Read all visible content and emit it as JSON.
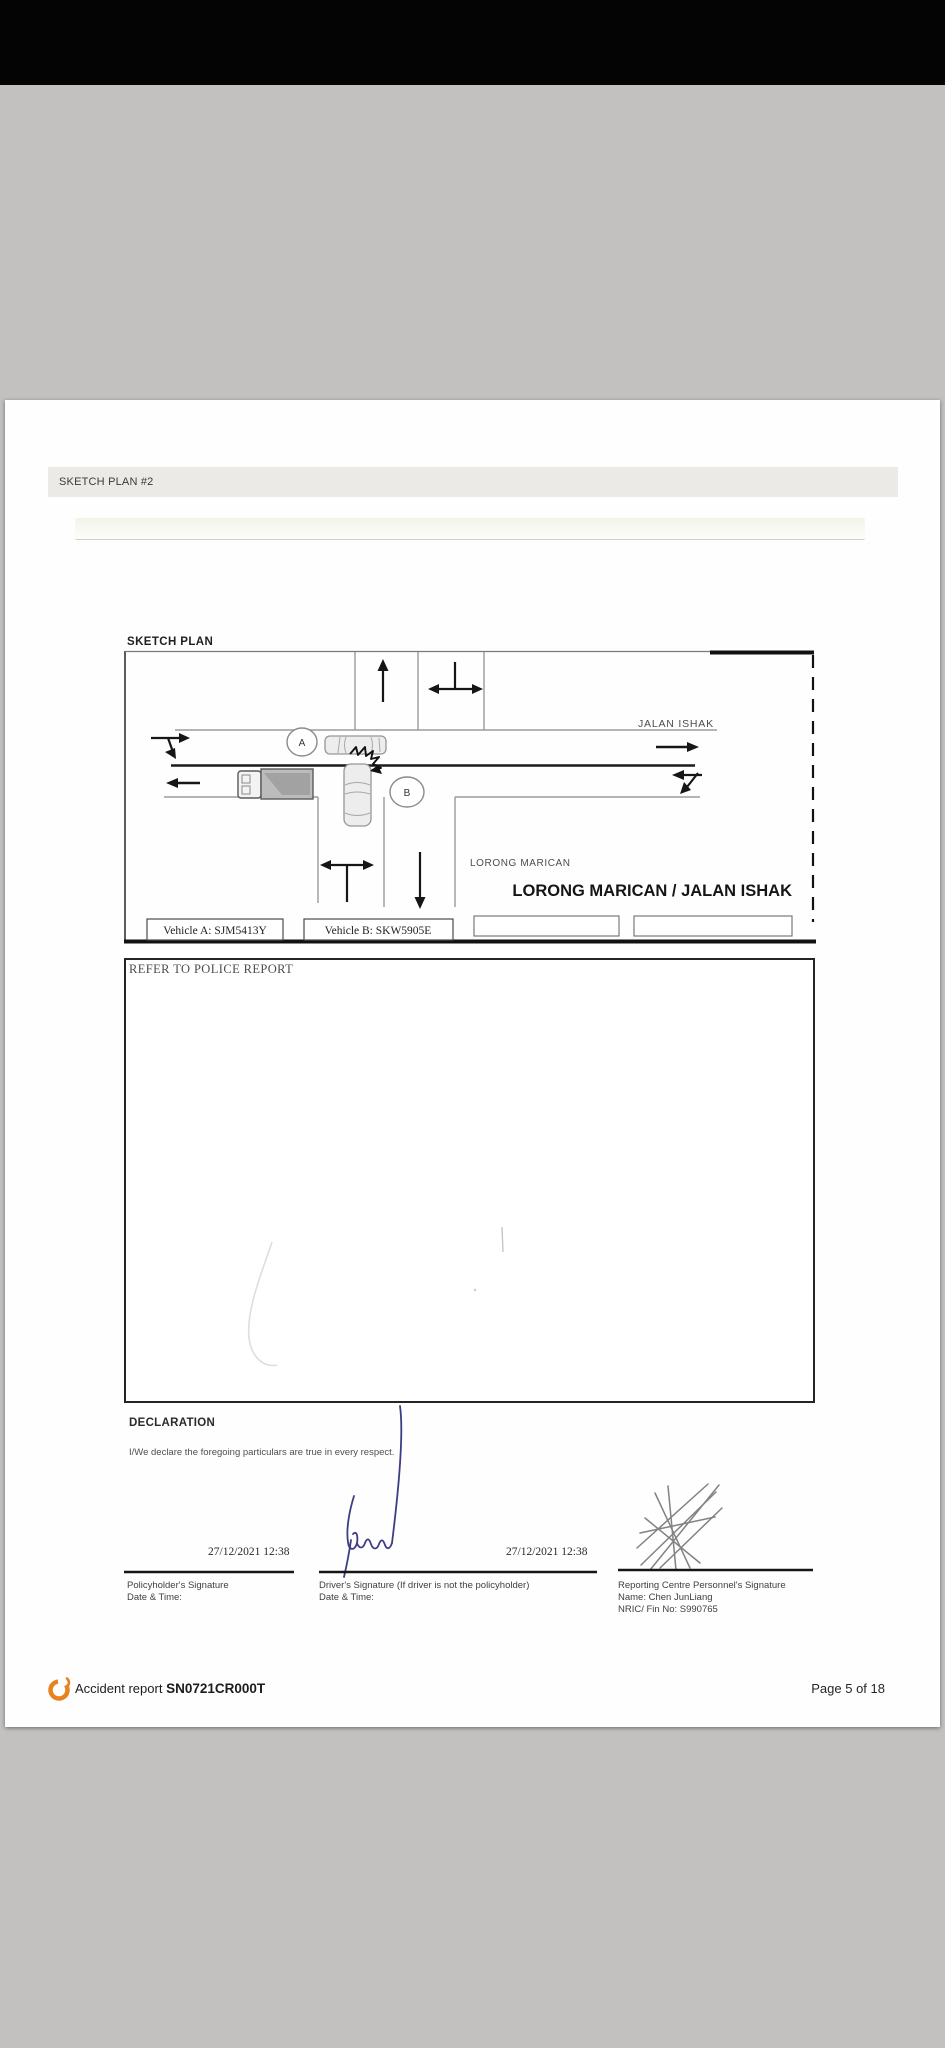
{
  "colors": {
    "logo_orange": "#e8821e",
    "signature_ink": "#3d3d85"
  },
  "header": {
    "title": "SKETCH PLAN #2"
  },
  "sketch": {
    "heading": "SKETCH PLAN",
    "labels": {
      "road_top": "JALAN ISHAK",
      "road_bottom": "LORONG MARICAN",
      "junction": "LORONG MARICAN / JALAN ISHAK",
      "marker_a": "A",
      "marker_b": "B"
    },
    "vehicle_boxes": [
      {
        "label": "Vehicle A: SJM5413Y"
      },
      {
        "label": "Vehicle B: SKW5905E"
      },
      {
        "label": ""
      },
      {
        "label": ""
      }
    ]
  },
  "description": {
    "text": "REFER TO POLICE REPORT"
  },
  "declaration": {
    "heading": "DECLARATION",
    "statement": "I/We declare the foregoing particulars are true in every respect.",
    "signatures": [
      {
        "datetime": "27/12/2021 12:38",
        "label": "Policyholder's Signature",
        "sublabel": "Date & Time:"
      },
      {
        "datetime": "27/12/2021 12:38",
        "label": "Driver's Signature (If driver is not the policyholder)",
        "sublabel": "Date & Time:"
      },
      {
        "label": "Reporting Centre Personnel's Signature",
        "name": "Name: Chen JunLiang",
        "nric": "NRIC/ Fin No: S990765"
      }
    ]
  },
  "footer": {
    "report_label": "Accident report",
    "report_number": "SN0721CR000T",
    "page_indicator": "Page 5 of 18"
  }
}
